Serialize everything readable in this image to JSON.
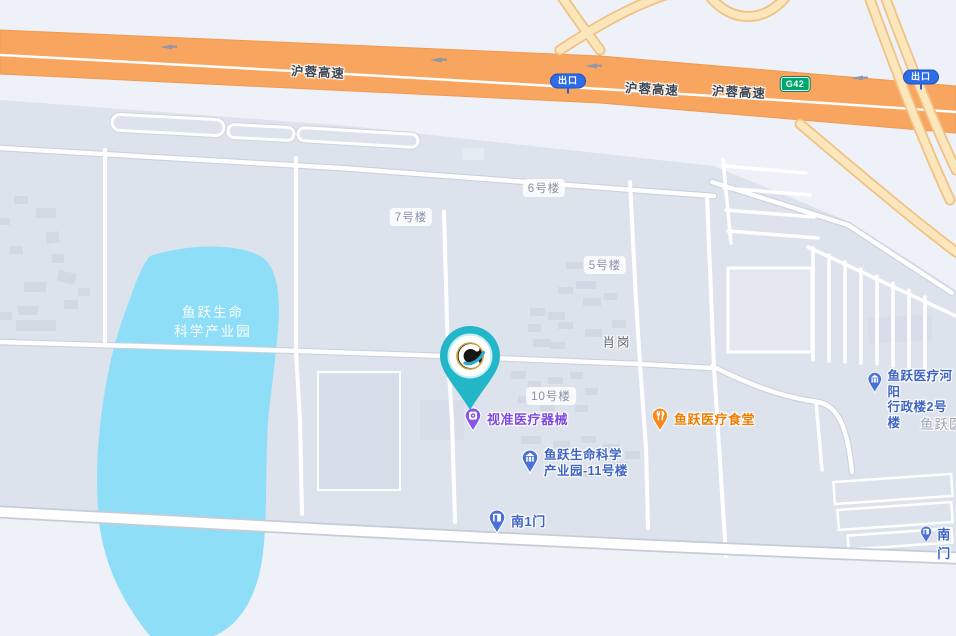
{
  "map": {
    "highway": {
      "name": "沪蓉高速",
      "name_2": "沪蓉高速",
      "name_3": "沪蓉高速",
      "exit_badge": "出口",
      "exit_badge_2": "出口",
      "route_code": "G42"
    },
    "water": {
      "label_line1": "鱼跃生命",
      "label_line2": "科学产业园"
    },
    "building_labels": {
      "b7": "7号楼",
      "b6": "6号楼",
      "b5": "5号楼",
      "b10": "10号楼"
    },
    "area_labels": {
      "xiaogang": "肖岗",
      "right_edge_partial": "鱼跃医"
    },
    "pois": {
      "shizhun": {
        "name": "视准医疗器械"
      },
      "canteen": {
        "name": "鱼跃医疗食堂"
      },
      "admin": {
        "line1": "鱼跃医疗河阳",
        "line2": "行政楼2号楼"
      },
      "park11": {
        "line1": "鱼跃生命科学",
        "line2": "产业园-11号楼"
      },
      "south_gate_1": {
        "name": "南1门"
      },
      "south_gate": {
        "name": "南门"
      }
    },
    "icons": {
      "center_marker": "location-pin",
      "shizhun": "device-marker-icon",
      "canteen": "restaurant-marker-icon",
      "admin": "building-marker-icon",
      "park11": "building-marker-icon",
      "gates": "gate-marker-icon",
      "highway_arrows": "west-arrow-icon"
    },
    "colors": {
      "background": "#EEF1F8",
      "campus": "#DDE3ED",
      "water": "#8EDEF7",
      "highway": "#F7A55F",
      "ramp": "#FBE5BA",
      "road": "#FFFFFF",
      "pin_teal": "#23B6C9",
      "poi_purple": "#7C4AE0",
      "poi_orange": "#F07C00",
      "poi_blue": "#3D64C5"
    }
  }
}
